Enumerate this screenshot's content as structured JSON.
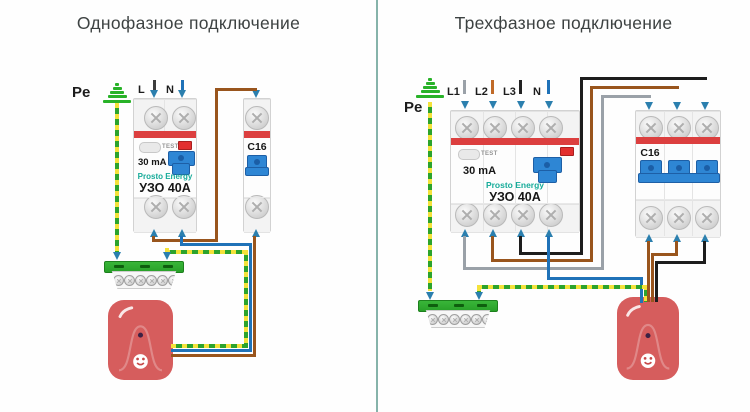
{
  "left": {
    "title": "Однофазное подключение",
    "pe_label": "Pe",
    "phase_label": "L",
    "neutral_label": "N",
    "rcd": {
      "test_label": "TEST",
      "rating": "30 mA",
      "brand": "Prosto Energy",
      "model": "УЗО 40А"
    },
    "breaker": {
      "model": "C16"
    }
  },
  "right": {
    "title": "Трехфазное подключение",
    "pe_label": "Pe",
    "phase_labels": [
      "L1",
      "L2",
      "L3"
    ],
    "neutral_label": "N",
    "rcd": {
      "test_label": "TEST",
      "rating": "30 mA",
      "brand": "Prosto Energy",
      "model": "УЗО 40А"
    },
    "breaker": {
      "model": "C16"
    }
  },
  "colors": {
    "phase_brown": "#99551d",
    "phase_gray": "#9aa1a8",
    "phase_black": "#1d1d1d",
    "neutral_blue": "#1f72b8",
    "pe_yellow": "#f4e23a",
    "pe_green": "#2ca32c",
    "earth_green": "#28b228",
    "bus_green": "#2fae2f",
    "device_red": "#d65d5d",
    "stripe_red": "#dc3f3f",
    "toggle_blue": "#2e86d4",
    "arrow_blue": "#2b7fae",
    "brand_teal": "#16ab99",
    "divider_teal": "#86b3aa",
    "title_gray": "#3d4242"
  }
}
